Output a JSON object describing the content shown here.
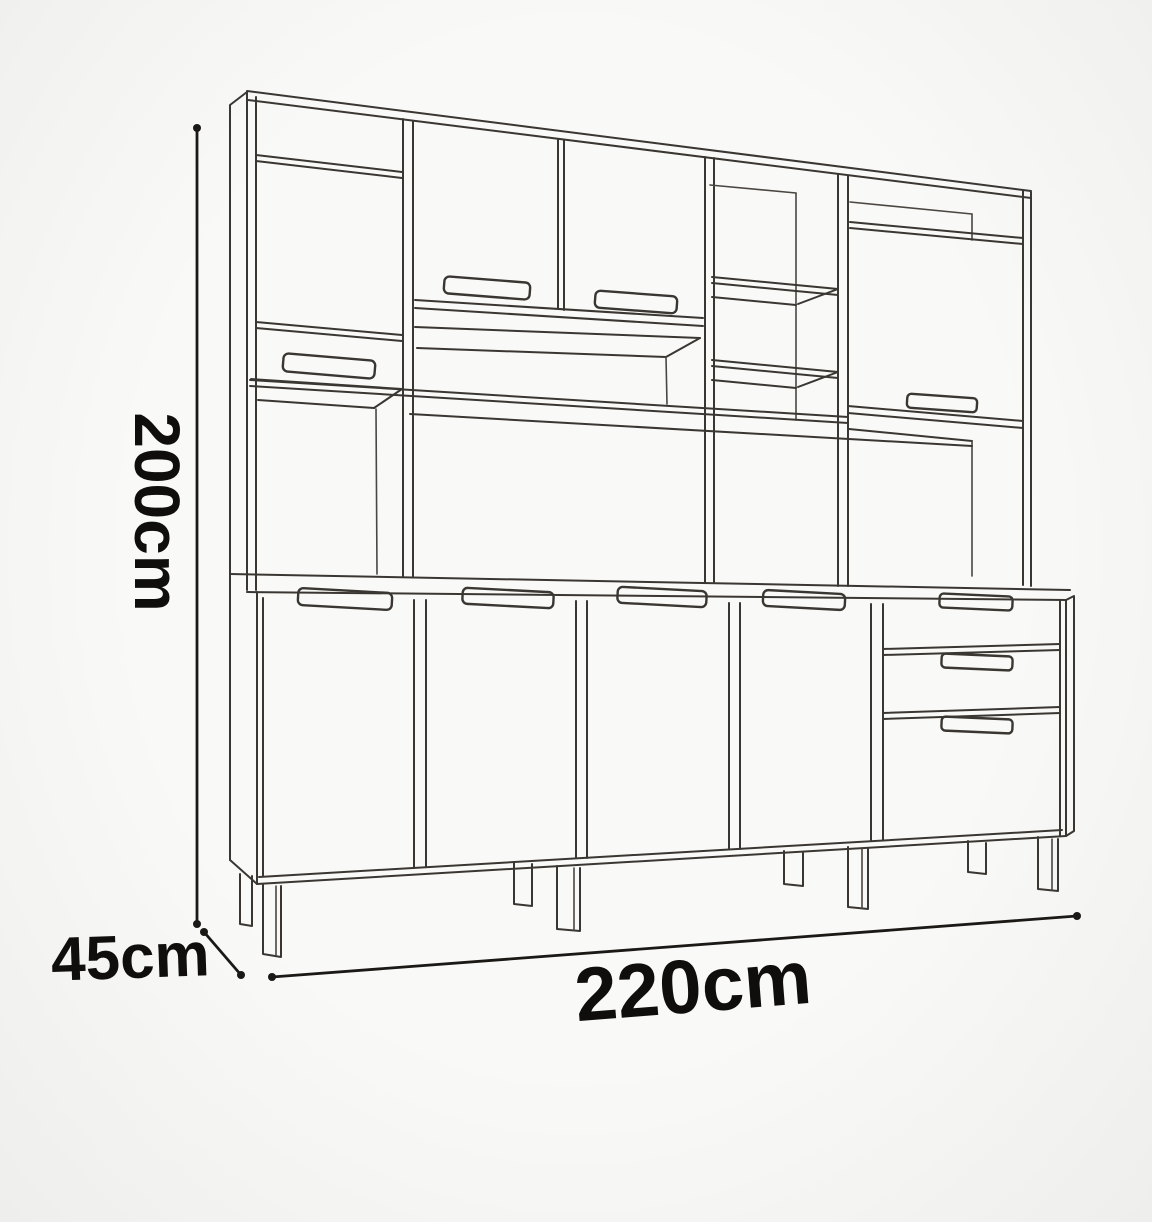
{
  "diagram": {
    "subject": "kitchen cabinet technical line drawing with overall dimensions",
    "dimensions": {
      "height_label": "200cm",
      "depth_label": "45cm",
      "width_label": "220cm"
    },
    "colors": {
      "background": "#f6f6f4",
      "line": "#3a3733",
      "dimension_line": "#1b1916",
      "label_text": "#0f0e0c"
    }
  }
}
